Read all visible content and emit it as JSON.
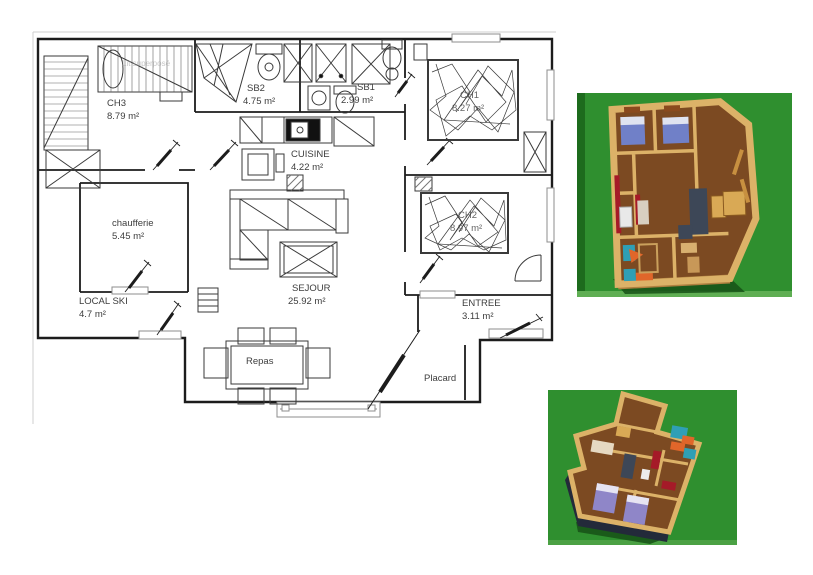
{
  "document": {
    "type": "architect-floor-plan-sheet",
    "views": [
      "2d-plan",
      "3d-overview-top",
      "3d-overview-bottom"
    ]
  },
  "plan": {
    "rooms": [
      {
        "id": "ch3",
        "name": "CH3",
        "area": "8.79 m²"
      },
      {
        "id": "sb2",
        "name": "SB2",
        "area": "4.75 m²"
      },
      {
        "id": "sb1",
        "name": "SB1",
        "area": "2.99 m²"
      },
      {
        "id": "cuisine",
        "name": "CUISINE",
        "area": "4.22 m²"
      },
      {
        "id": "ch1",
        "name": "CH1",
        "area": "8.27 m²"
      },
      {
        "id": "ch2",
        "name": "CH2",
        "area": "8.97 m²"
      },
      {
        "id": "chaufferie",
        "name": "chaufferie",
        "area": "5.45 m²"
      },
      {
        "id": "local_ski",
        "name": "LOCAL SKI",
        "area": "4.7 m²"
      },
      {
        "id": "sejour",
        "name": "SEJOUR",
        "area": "25.92 m²"
      },
      {
        "id": "entree",
        "name": "ENTREE",
        "area": "3.11 m²"
      }
    ],
    "labels": {
      "repas": "Repas",
      "placard": "Placard",
      "bunk_bed": "Lit superposé"
    }
  },
  "colors": {
    "plan_line": "#1c1c1c",
    "grass_green": "#2f8f2f",
    "grass_dark": "#1d6b1d",
    "grass_light": "#5fae53",
    "shadow_green": "#165116",
    "wall_tan": "#dcb268",
    "wall_tan_dark": "#b08040",
    "floor_brown": "#7c4a22",
    "bed_blue": "#7080c8",
    "bed_violet": "#8f86c8",
    "accent_red": "#a51a28",
    "accent_teal": "#2f9fb5",
    "accent_orange": "#e0662a",
    "sofa_slate": "#3d4757",
    "wood_light": "#d9a955",
    "dark_wall": "#232a3a"
  }
}
